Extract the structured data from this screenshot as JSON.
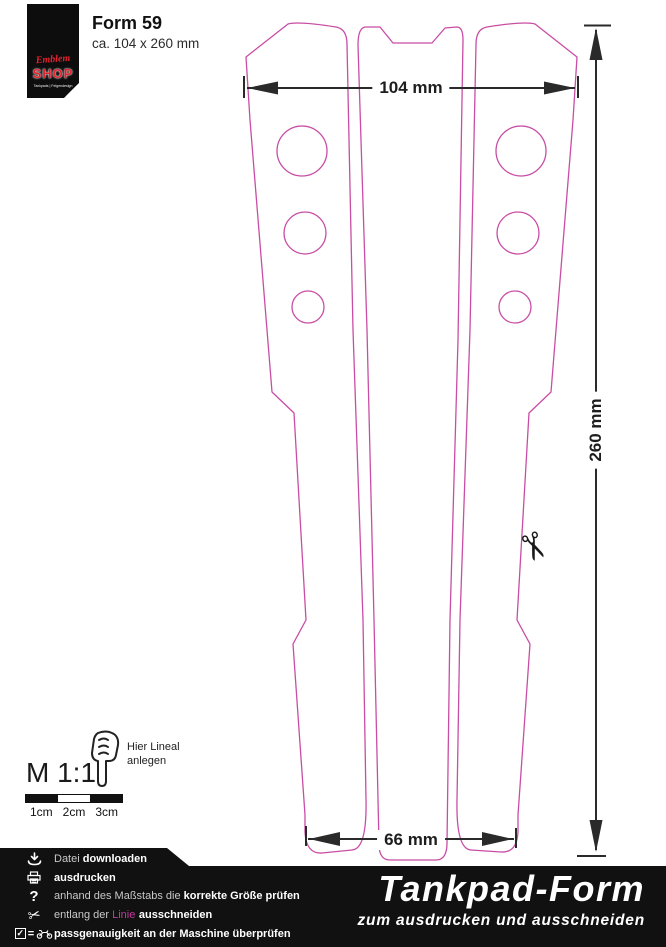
{
  "header": {
    "title": "Form 59",
    "subtitle": "ca. 104 x 260 mm"
  },
  "logo": {
    "script_text": "Emblem",
    "shop_text": "SHOP",
    "caption": "Tankpads | Felgendesign"
  },
  "dimensions": {
    "top_width": "104 mm",
    "side_height": "260 mm",
    "bottom_width": "66 mm"
  },
  "scale": {
    "label": "M 1:1",
    "hint_line1": "Hier Lineal",
    "hint_line2": "anlegen",
    "ruler_ticks": [
      "1cm",
      "2cm",
      "3cm"
    ]
  },
  "icons": {
    "scissors": "✂",
    "check": "✓",
    "equals": "=",
    "question": "?"
  },
  "footer": {
    "steps": [
      {
        "icon": "download-icon",
        "pre": "Datei ",
        "bold": "downloaden"
      },
      {
        "icon": "printer-icon",
        "bold": "ausdrucken"
      },
      {
        "icon": "question-icon",
        "pre": "anhand des Maßstabs die ",
        "bold": "korrekte Größe prüfen"
      },
      {
        "icon": "scissors-icon",
        "pre": "entlang der ",
        "accent": "Linie",
        "bold": "ausschneiden"
      },
      {
        "icon": "checklist-icon",
        "bold": "passgenauigkeit an der Maschine überprüfen"
      }
    ],
    "title": "Tankpad-Form",
    "subtitle": "zum ausdrucken und ausschneiden"
  },
  "colors": {
    "outline_pink": "#c84da4",
    "accent_magenta": "#b5338a",
    "logo_red": "#e3212e",
    "dimension": "#2a2a2a"
  }
}
